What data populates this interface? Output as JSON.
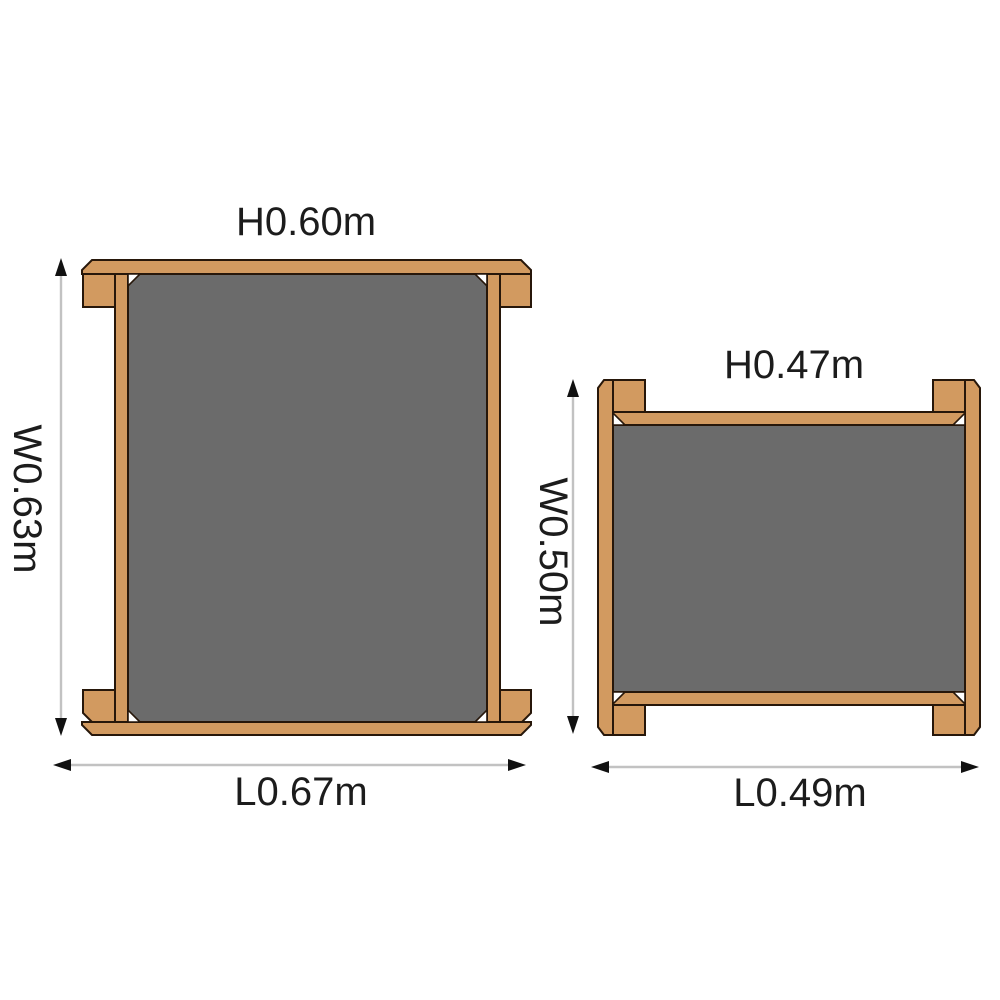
{
  "diagram": {
    "type": "furniture-dimension-diagram",
    "background_color": "#ffffff",
    "colors": {
      "wood": "#d29a60",
      "wood_outline": "#27170a",
      "panel_gray": "#6b6b6b",
      "dimension_line": "#c2c2c2",
      "arrowhead": "#111111",
      "text": "#1c1c1c"
    },
    "tables": [
      {
        "name": "large-table",
        "height_label": "H0.60m",
        "width_label": "W0.63m",
        "length_label": "L0.67m"
      },
      {
        "name": "small-table",
        "height_label": "H0.47m",
        "width_label": "W0.50m",
        "length_label": "L0.49m"
      }
    ]
  }
}
